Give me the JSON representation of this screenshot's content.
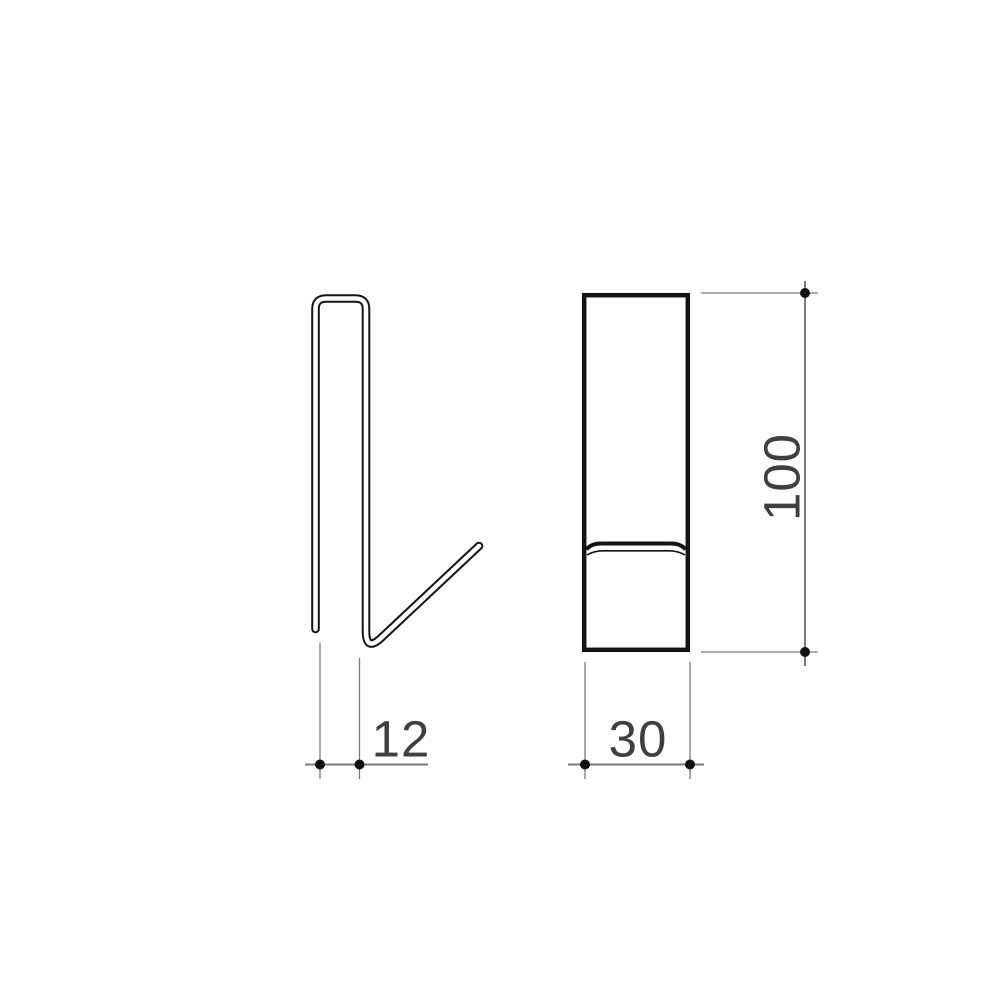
{
  "drawing": {
    "background_color": "#ffffff",
    "outline_color": "#141414",
    "inner_fill_color": "#ffffff",
    "dimension_line_color": "#7a7a7a",
    "dot_color": "#111111",
    "label_color": "#3f3f3f",
    "dimensions": {
      "hook_gap": {
        "label": "12",
        "orientation": "horizontal"
      },
      "width": {
        "label": "30",
        "orientation": "horizontal"
      },
      "height": {
        "label": "100",
        "orientation": "vertical"
      }
    }
  }
}
